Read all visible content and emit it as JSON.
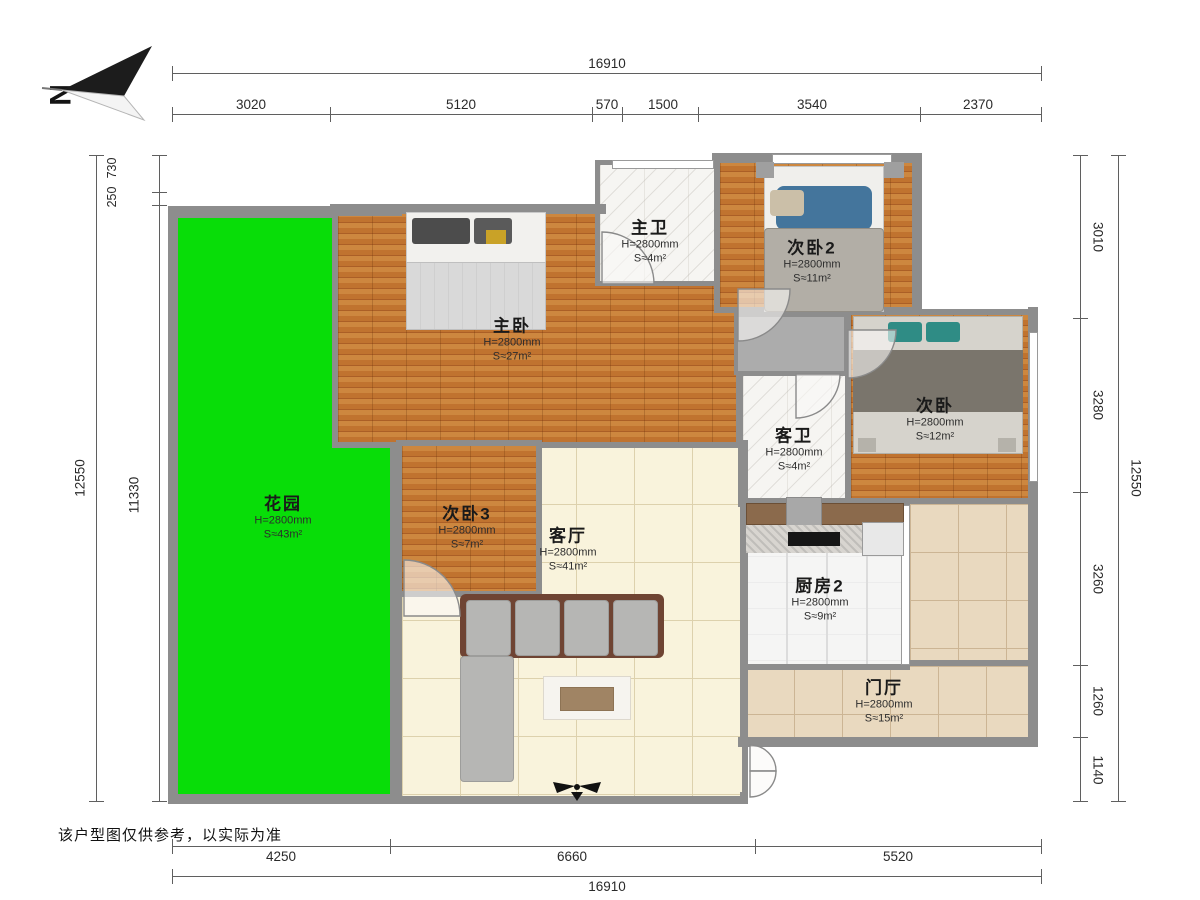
{
  "meta": {
    "north_label": "N",
    "disclaimer": "该户型图仅供参考，以实际为准"
  },
  "dimensions": {
    "top": {
      "total": "16910",
      "segments": [
        "3020",
        "5120",
        "570",
        "1500",
        "3540",
        "2370"
      ]
    },
    "bottom": {
      "total": "16910",
      "segments": [
        "4250",
        "6660",
        "5520"
      ]
    },
    "left": {
      "total": "12550",
      "segments": [
        "730",
        "250",
        "11330"
      ]
    },
    "right": {
      "total": "12550",
      "segments": [
        "3010",
        "3280",
        "3260",
        "1260",
        "1140"
      ]
    }
  },
  "rooms": {
    "master_bath": {
      "name": "主卫",
      "height": "H=2800mm",
      "area": "S≈4m²"
    },
    "bedroom2": {
      "name": "次卧2",
      "height": "H=2800mm",
      "area": "S≈11m²"
    },
    "master_bedroom": {
      "name": "主卧",
      "height": "H=2800mm",
      "area": "S≈27m²"
    },
    "bedroom": {
      "name": "次卧",
      "height": "H=2800mm",
      "area": "S≈12m²"
    },
    "guest_bath": {
      "name": "客卫",
      "height": "H=2800mm",
      "area": "S≈4m²"
    },
    "garden": {
      "name": "花园",
      "height": "H=2800mm",
      "area": "S≈43m²"
    },
    "bedroom3": {
      "name": "次卧3",
      "height": "H=2800mm",
      "area": "S≈7m²"
    },
    "living": {
      "name": "客厅",
      "height": "H=2800mm",
      "area": "S≈41m²"
    },
    "kitchen2": {
      "name": "厨房2",
      "height": "H=2800mm",
      "area": "S≈9m²"
    },
    "foyer": {
      "name": "门厅",
      "height": "H=2800mm",
      "area": "S≈15m²"
    }
  },
  "colors": {
    "garden_green": "#08dd08",
    "wood_floor": "#c0732f",
    "wall_gray": "#8d8d8d",
    "living_tile": "#f9f3dc",
    "foyer_tile": "#e9d9bf"
  }
}
